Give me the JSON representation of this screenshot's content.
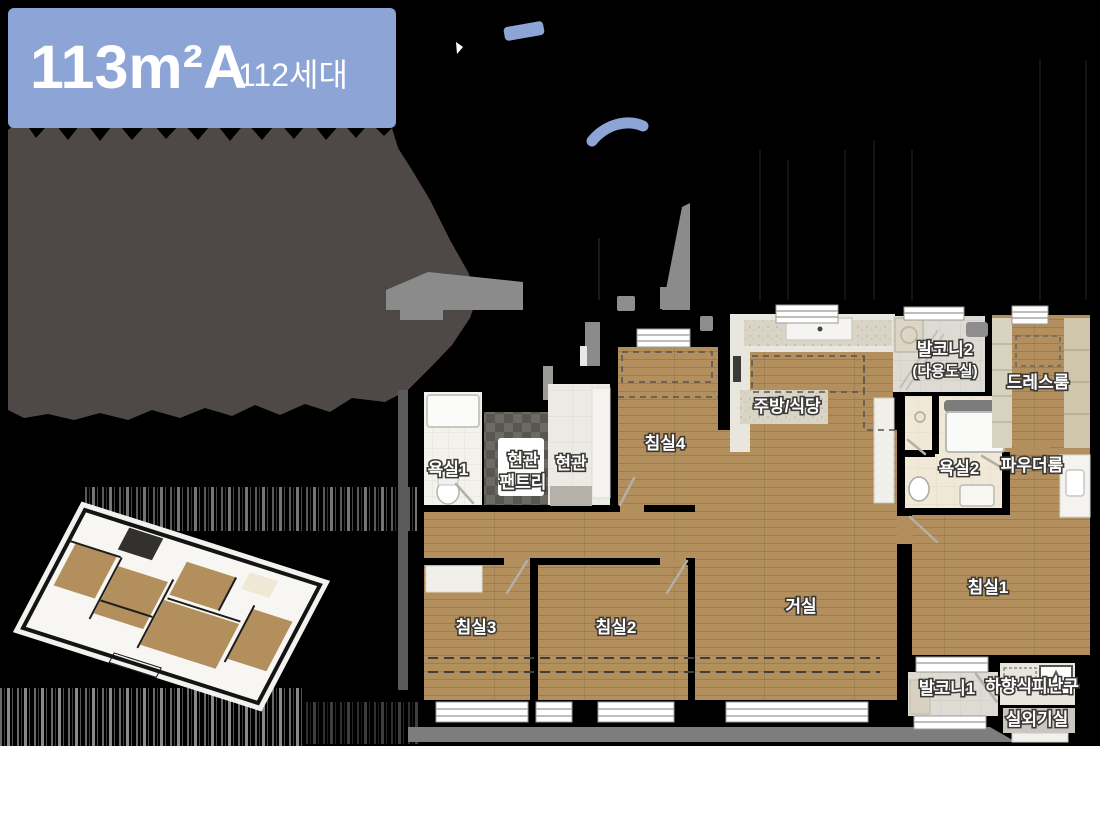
{
  "badge": {
    "area_label": "113m²A",
    "units_label": "112세대",
    "color": "#8CA5D6"
  },
  "floor_plan": {
    "rooms": {
      "bath1": "욕실1",
      "entry_pantry_line1": "현관",
      "entry_pantry_line2": "팬트리",
      "entry": "현관",
      "bedroom4": "침실4",
      "kitchen_dining": "주방/식당",
      "balcony2_line1": "발코니2",
      "balcony2_line2": "(다용도실)",
      "dressroom": "드레스룸",
      "bath2": "욕실2",
      "powder_room": "파우더룸",
      "living": "거실",
      "bedroom1": "침실1",
      "bedroom2": "침실2",
      "bedroom3": "침실3",
      "balcony1": "발코니1",
      "escape_hatch": "하향식피난구",
      "ac_unit_room": "실외기실"
    }
  },
  "palette": {
    "wall_black": "#000000",
    "wood_floor": "#B28F5C",
    "masked_blob_gray": "#4E4946",
    "masked_light_gray": "#8B8B8B",
    "accent_blue": "#8CA5D6",
    "ground_strip_gray": "#7D7D7D",
    "bath_cream_tile": "#F0E9D8",
    "balcony_tile": "#DDDBD3"
  }
}
